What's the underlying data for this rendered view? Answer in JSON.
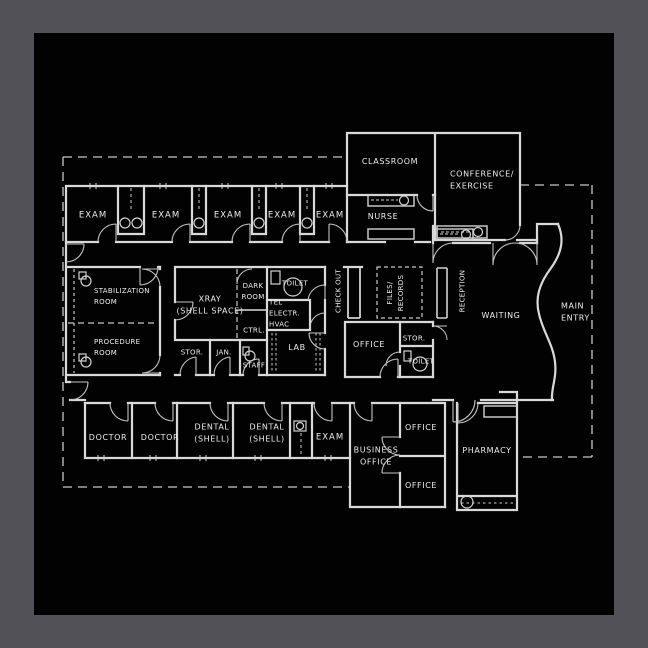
{
  "palette": {
    "frame": "#515157",
    "paper": "#020202",
    "wall_line": "#d9d9d9",
    "door_line": "#c4c4c4",
    "dashed_line": "#c9c9c9",
    "label_text": "#ededed"
  },
  "drawing": {
    "type": "architectural floor plan",
    "building": "medical clinic single-storey plan"
  },
  "rooms": {
    "exam1": "EXAM",
    "exam2": "EXAM",
    "exam3": "EXAM",
    "exam4": "EXAM",
    "exam5": "EXAM",
    "classroom": "CLASSROOM",
    "nurse": "NURSE",
    "conference": "CONFERENCE/\nEXERCISE",
    "stabilization": "STABILIZATION\nROOM",
    "procedure": "PROCEDURE\nROOM",
    "xray": "XRAY\n(SHELL SPACE)",
    "darkroom": "DARK\nROOM",
    "ctrl": "CTRL.",
    "stor1": "STOR.",
    "jan": "JAN.",
    "staff": "STAFF",
    "toilet1": "TOILET",
    "tel": "TEL\nELECTR.\nHVAC",
    "lab": "LAB",
    "checkout": "CHECK OUT",
    "files": "FILES/\nRECORDS",
    "office1": "OFFICE",
    "stor2": "STOR.",
    "toilet2": "TOILET",
    "reception": "RECEPTION",
    "waiting": "WAITING",
    "main_entry": "MAIN\nENTRY",
    "doctor1": "DOCTOR",
    "doctor2": "DOCTOR",
    "dental1": "DENTAL\n(SHELL)",
    "dental2": "DENTAL\n(SHELL)",
    "exam6": "EXAM",
    "business": "BUSINESS\nOFFICE",
    "office2": "OFFICE",
    "office3": "OFFICE",
    "pharmacy": "PHARMACY"
  }
}
